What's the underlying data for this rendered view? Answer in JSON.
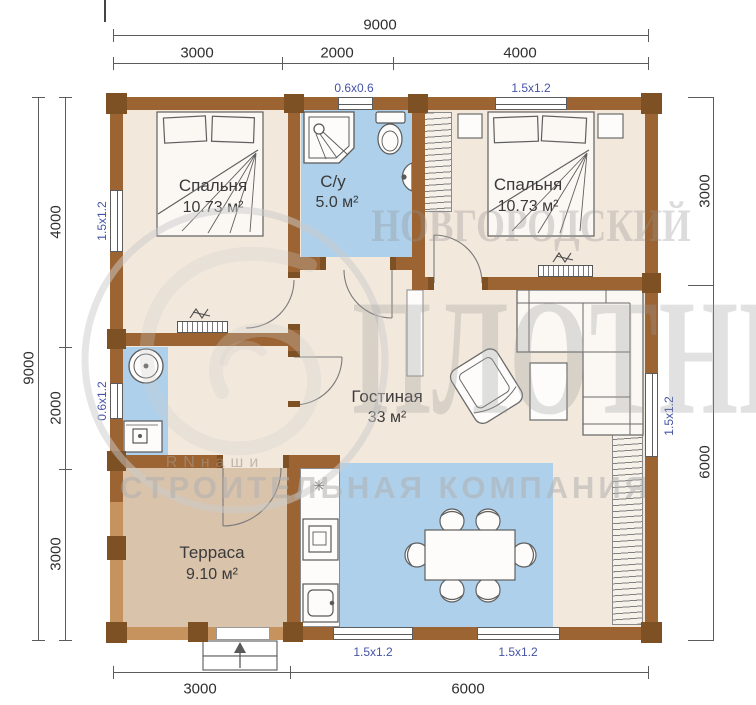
{
  "rooms": {
    "bedroom1": {
      "name": "Спальня",
      "area": "10.73 м²"
    },
    "bathroom": {
      "name": "С/у",
      "area": "5.0 м²"
    },
    "bedroom2": {
      "name": "Спальня",
      "area": "10.73 м²"
    },
    "living": {
      "name": "Гостиная",
      "area": "33 м²"
    },
    "terrace": {
      "name": "Терраса",
      "area": "9.10 м²"
    }
  },
  "dimensions": {
    "top_total": "9000",
    "top_segments": [
      "3000",
      "2000",
      "4000"
    ],
    "left_total": "9000",
    "left_segments": [
      "4000",
      "2000",
      "3000"
    ],
    "right_segments": [
      "3000",
      "6000"
    ],
    "bottom_segments": [
      "3000",
      "6000"
    ]
  },
  "window_labels": {
    "top_bath": "0.6x0.6",
    "top_bedroom2": "1.5x1.2",
    "left_bedroom1": "1.5x1.2",
    "left_utility": "0.6x1.2",
    "right_living": "1.5x1.2",
    "bottom_left": "1.5x1.2",
    "bottom_right": "1.5x1.2"
  },
  "watermark": {
    "line1": "НОВГОРОДСКИЙ",
    "line2": "ПЛОТНИК",
    "line3": "СТРОИТЕЛЬНАЯ КОМПАНИЯ",
    "small_text": "RNнаши"
  },
  "icons": {
    "stove_burner": "✳"
  },
  "colors": {
    "wall": "#9c6433",
    "wall_joint": "#7e5124",
    "terrace_wall": "#c6935f",
    "floor": "#f3e8dc",
    "wet_floor": "#aed0ea",
    "terrace_floor": "#d9c3ab",
    "window_label": "#4553a6",
    "dim_text": "#2f2f2f"
  }
}
